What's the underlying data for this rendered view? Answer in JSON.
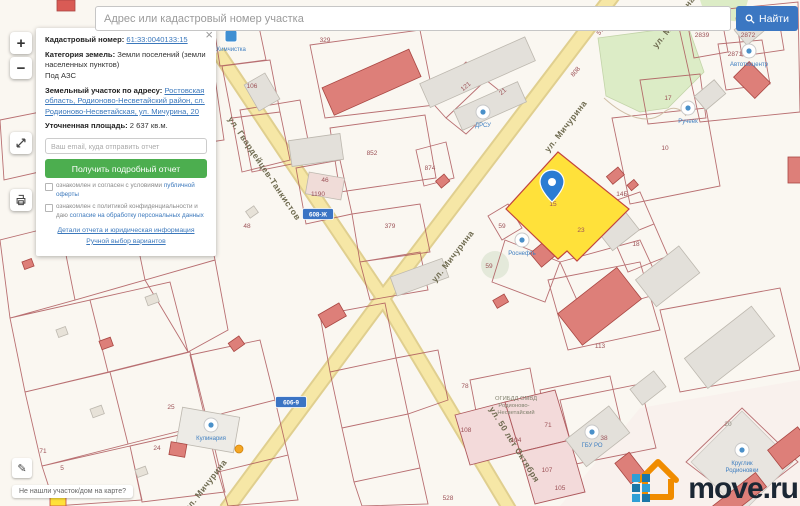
{
  "search": {
    "placeholder": "Адрес или кадастровый номер участка",
    "button": "Найти"
  },
  "controls": {
    "zoom_in": "+",
    "zoom_out": "−"
  },
  "panel": {
    "close": "×",
    "cadastral_label": "Кадастровый номер:",
    "cadastral_value": "61:33:0040133:15",
    "category_label": "Категория земель:",
    "category_value": "Земли поселений (земли населенных пунктов)",
    "category_extra": "Под АЗС",
    "address_label": "Земельный участок по адресу:",
    "address_value": "Ростовская область, Родионово-Несветайский район, сл. Родионово-Несветайская, ул. Мичурина, 20",
    "area_label": "Уточненная площадь:",
    "area_value": "2 637 кв.м.",
    "email_placeholder": "Ваш email, куда отправить отчет",
    "submit_button": "Получить подробный отчет",
    "checkbox1_text": "ознакомлен и согласен с условиями ",
    "checkbox1_link": "публичной оферты",
    "checkbox2_text": "ознакомлен с политикой конфиденциальности и даю ",
    "checkbox2_link": "согласие на обработку персональных данных",
    "link_details": "Детали отчета и юридическая информация",
    "link_manual": "Ручной выбор вариантов"
  },
  "footer": {
    "not_found": "Не нашли участок/дом на карте?",
    "logo_text": "move.ru"
  },
  "map": {
    "selected_parcel_number": "15",
    "streets": [
      {
        "text": "ул. Мичурина",
        "x": 568,
        "y": 128,
        "rot": -52
      },
      {
        "text": "ул. Мичурина",
        "x": 455,
        "y": 258,
        "rot": -52
      },
      {
        "text": "ул. Мичурина",
        "x": 208,
        "y": 487,
        "rot": -52
      },
      {
        "text": "ул. Мичурина",
        "x": 676,
        "y": 24,
        "rot": -52
      },
      {
        "text": "ул. Гвардейцев-Танкистов",
        "x": 262,
        "y": 170,
        "rot": 56
      },
      {
        "text": "ул. 50 лет Октября",
        "x": 512,
        "y": 446,
        "rot": 58
      }
    ],
    "labels": [
      {
        "text": "106",
        "x": 252,
        "y": 88
      },
      {
        "text": "329",
        "x": 325,
        "y": 42
      },
      {
        "text": "852",
        "x": 372,
        "y": 155
      },
      {
        "text": "874",
        "x": 430,
        "y": 170
      },
      {
        "text": "1190",
        "x": 318,
        "y": 196
      },
      {
        "text": "121",
        "x": 467,
        "y": 88,
        "rot": -40
      },
      {
        "text": "21",
        "x": 504,
        "y": 93,
        "rot": -40
      },
      {
        "text": "379",
        "x": 390,
        "y": 228
      },
      {
        "text": "46",
        "x": 325,
        "y": 182
      },
      {
        "text": "5730",
        "x": 604,
        "y": 30,
        "rot": -50
      },
      {
        "text": "808",
        "x": 577,
        "y": 73,
        "rot": -50
      },
      {
        "text": "2839",
        "x": 702,
        "y": 37
      },
      {
        "text": "2872",
        "x": 748,
        "y": 37
      },
      {
        "text": "2871",
        "x": 735,
        "y": 56
      },
      {
        "text": "17",
        "x": 668,
        "y": 100
      },
      {
        "text": "10",
        "x": 665,
        "y": 150
      },
      {
        "text": "14Б",
        "x": 622,
        "y": 196
      },
      {
        "text": "18",
        "x": 636,
        "y": 246
      },
      {
        "text": "59",
        "x": 502,
        "y": 228
      },
      {
        "text": "59",
        "x": 489,
        "y": 268
      },
      {
        "text": "23",
        "x": 581,
        "y": 232
      },
      {
        "text": "15",
        "x": 553,
        "y": 206
      },
      {
        "text": "25",
        "x": 171,
        "y": 409
      },
      {
        "text": "24",
        "x": 157,
        "y": 450
      },
      {
        "text": "71",
        "x": 43,
        "y": 453
      },
      {
        "text": "5",
        "x": 62,
        "y": 470
      },
      {
        "text": "48",
        "x": 247,
        "y": 228
      },
      {
        "text": "78",
        "x": 465,
        "y": 388
      },
      {
        "text": "71",
        "x": 548,
        "y": 427
      },
      {
        "text": "528",
        "x": 448,
        "y": 500
      },
      {
        "text": "108",
        "x": 466,
        "y": 432
      },
      {
        "text": "104",
        "x": 516,
        "y": 442
      },
      {
        "text": "107",
        "x": 547,
        "y": 472
      },
      {
        "text": "105",
        "x": 560,
        "y": 490
      },
      {
        "text": "113",
        "x": 600,
        "y": 348
      },
      {
        "text": "38",
        "x": 604,
        "y": 440
      },
      {
        "text": "20",
        "x": 728,
        "y": 426,
        "cls": "dark"
      },
      {
        "text": "ОГИБДД ОМВД",
        "x": 516,
        "y": 400,
        "cls": "gray"
      },
      {
        "text": "Родионово-",
        "x": 514,
        "y": 407,
        "cls": "gray"
      },
      {
        "text": "Несветайский",
        "x": 516,
        "y": 414,
        "cls": "gray"
      }
    ],
    "badges": [
      {
        "text": "608-Ж",
        "x": 318,
        "y": 214
      },
      {
        "text": "606-9",
        "x": 291,
        "y": 402
      }
    ],
    "pois": [
      {
        "label": "ДРСУ",
        "x": 483,
        "y": 112
      },
      {
        "label": "Роснефть",
        "x": 522,
        "y": 240
      },
      {
        "label": "Кулинария",
        "x": 211,
        "y": 425
      },
      {
        "label": "ГБУ РО",
        "x": 592,
        "y": 432
      },
      {
        "label": "Автотехцентр",
        "x": 749,
        "y": 51
      },
      {
        "label": "Ручеек",
        "x": 688,
        "y": 108
      },
      {
        "label": "Круглик",
        "label2": "Родионовки",
        "x": 742,
        "y": 450
      },
      {
        "label": "Химчистка",
        "x": 231,
        "y": 36,
        "shape": "square"
      }
    ]
  },
  "colors": {
    "accent_blue": "#3b77c2",
    "button_green": "#4cae4f",
    "parcel_line": "#ad585c",
    "road_fill": "#f6e7a6",
    "selected_parcel": "#ffe13a",
    "pin_blue": "#2b7cd3",
    "logo_orange": "#f08c00",
    "logo_navy": "#1b2734"
  }
}
